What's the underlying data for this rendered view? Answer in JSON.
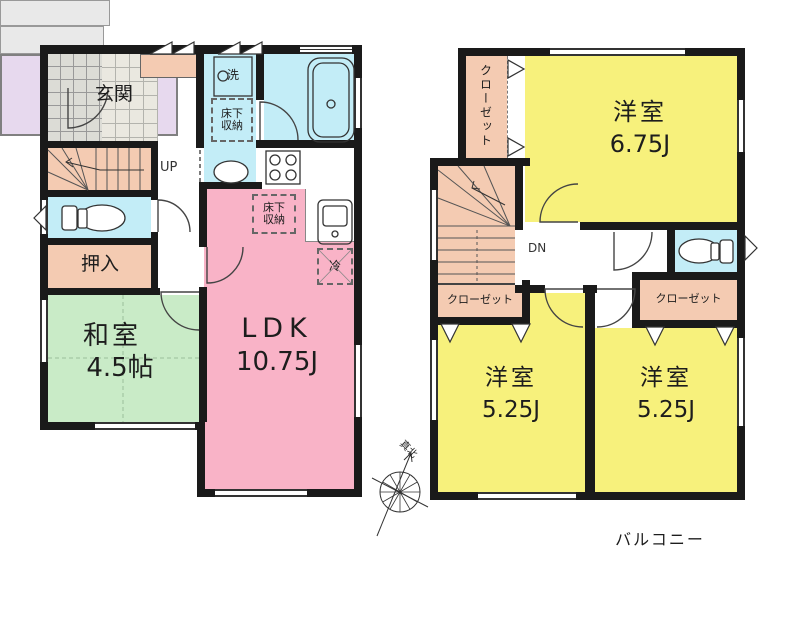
{
  "floor1": {
    "entrance": "玄関",
    "stairs_up": "UP",
    "closet_oshiire": "押入",
    "japanese_room_name": "和室",
    "japanese_room_size": "4.5帖",
    "ldk_name": "LDK",
    "ldk_size": "10.75J",
    "underfloor_storage_washroom": "床下収納",
    "underfloor_storage_ldk": "床下収納",
    "washer": "洗",
    "refrigerator": "冷"
  },
  "floor2": {
    "closet_top_left": "クローゼット",
    "closet_under_stairs": "クローゼット",
    "closet_right": "クローゼット",
    "stairs_down": "DN",
    "bedroom1_name": "洋室",
    "bedroom1_size": "6.75J",
    "bedroom2_name": "洋室",
    "bedroom2_size": "5.25J",
    "bedroom3_name": "洋室",
    "bedroom3_size": "5.25J",
    "balcony": "バルコニー"
  },
  "compass": {
    "true_north": "真北"
  },
  "colors": {
    "wall": "#1a1a1a",
    "ldk_pink": "#f9b3c7",
    "room_yellow": "#f7f17c",
    "tatami_green": "#c9ebc7",
    "water_blue": "#c3edf7",
    "closet_peach": "#f4cbb2",
    "balcony_purple": "#e7d9ee",
    "terrace_gray": "#e9e9e9"
  }
}
